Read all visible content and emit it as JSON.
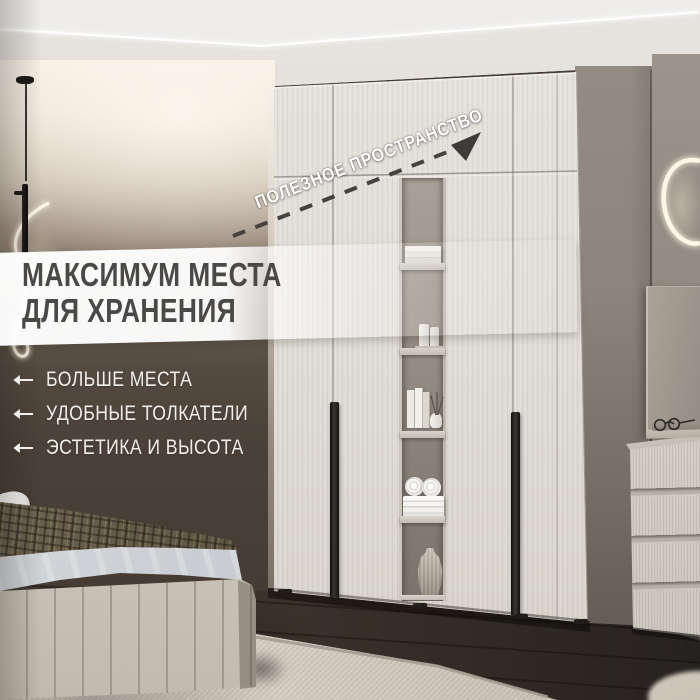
{
  "overlay": {
    "headline_line1": "МАКСИМУМ МЕСТА",
    "headline_line2": "ДЛЯ ХРАНЕНИЯ",
    "features": [
      {
        "label": "БОЛЬШЕ МЕСТА"
      },
      {
        "label": "УДОБНЫЕ ТОЛКАТЕЛИ"
      },
      {
        "label": "ЭСТЕТИКА И ВЫСОТА"
      }
    ],
    "callout_label": "ПОЛЕЗНОЕ ПРОСТРАНСТВО"
  },
  "colors": {
    "band": "#ffffff",
    "headline_text": "#4b4947",
    "feature_text": "#f2f0ed",
    "callout_text": "#ffffff",
    "dashed_line": "#45423f",
    "neon_light": "#faf2de",
    "wall_dark": "#473d35",
    "wardrobe_door": "#e0ddd7",
    "floor": "#362e28",
    "rug": "#d6d0c3"
  }
}
